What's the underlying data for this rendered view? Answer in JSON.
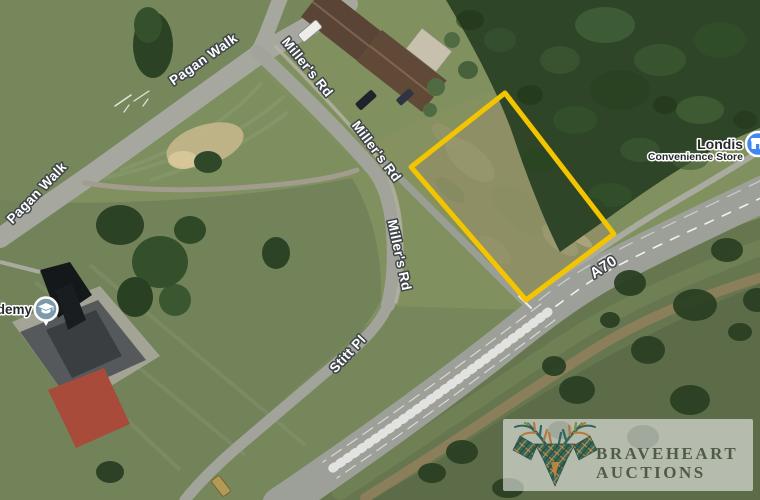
{
  "map": {
    "road_labels": [
      {
        "text": "Pagan Walk"
      },
      {
        "text": "Pagan Walk"
      },
      {
        "text": "Miller's Rd"
      },
      {
        "text": "Miller's Rd"
      },
      {
        "text": "Miller's Rd"
      },
      {
        "text": "Stitt Pl"
      },
      {
        "text": "A70"
      }
    ],
    "pois": [
      {
        "label": "demy",
        "icon": "graduation-cap",
        "pin_color": "#7D99AC"
      },
      {
        "label": "Londis",
        "sublabel": "Convenience Store",
        "icon": "convenience-store",
        "pin_color": "#4285F4"
      }
    ],
    "plot_boundary": {
      "color": "#F2C500"
    }
  },
  "logo": {
    "line1": "BRAVEHEART",
    "line2": "AUCTIONS",
    "icon": "stag-head",
    "text_color": "#4E5C46"
  }
}
